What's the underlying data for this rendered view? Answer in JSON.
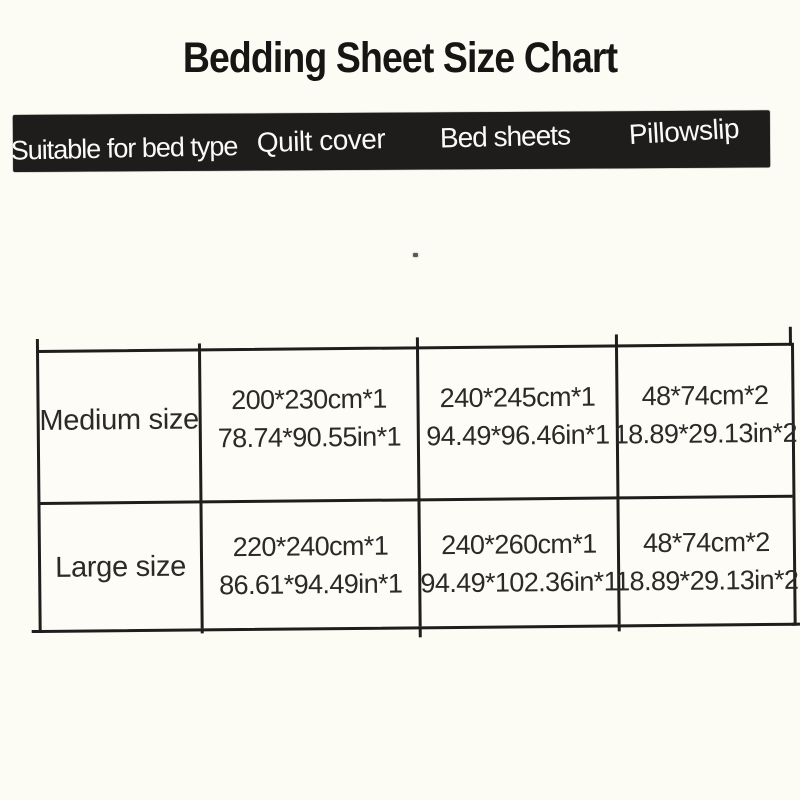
{
  "title": "Bedding Sheet Size Chart",
  "colors": {
    "page_background": "#fcfbf4",
    "header_bar_background": "#1e1d1b",
    "header_text": "#fafaf8",
    "table_line": "#1f1e1c",
    "body_text": "#2b2a28"
  },
  "header": {
    "columns": [
      "Suitable for bed type",
      "Quilt cover",
      "Bed sheets",
      "Pillowslip"
    ]
  },
  "table": {
    "rows": [
      {
        "label": "Medium size",
        "quilt_cover": {
          "cm": "200*230cm*1",
          "in": "78.74*90.55in*1"
        },
        "bed_sheets": {
          "cm": "240*245cm*1",
          "in": "94.49*96.46in*1"
        },
        "pillowslip": {
          "cm": "48*74cm*2",
          "in": "18.89*29.13in*2"
        }
      },
      {
        "label": "Large size",
        "quilt_cover": {
          "cm": "220*240cm*1",
          "in": "86.61*94.49in*1"
        },
        "bed_sheets": {
          "cm": "240*260cm*1",
          "in": "94.49*102.36in*1"
        },
        "pillowslip": {
          "cm": "48*74cm*2",
          "in": "18.89*29.13in*2"
        }
      }
    ]
  }
}
